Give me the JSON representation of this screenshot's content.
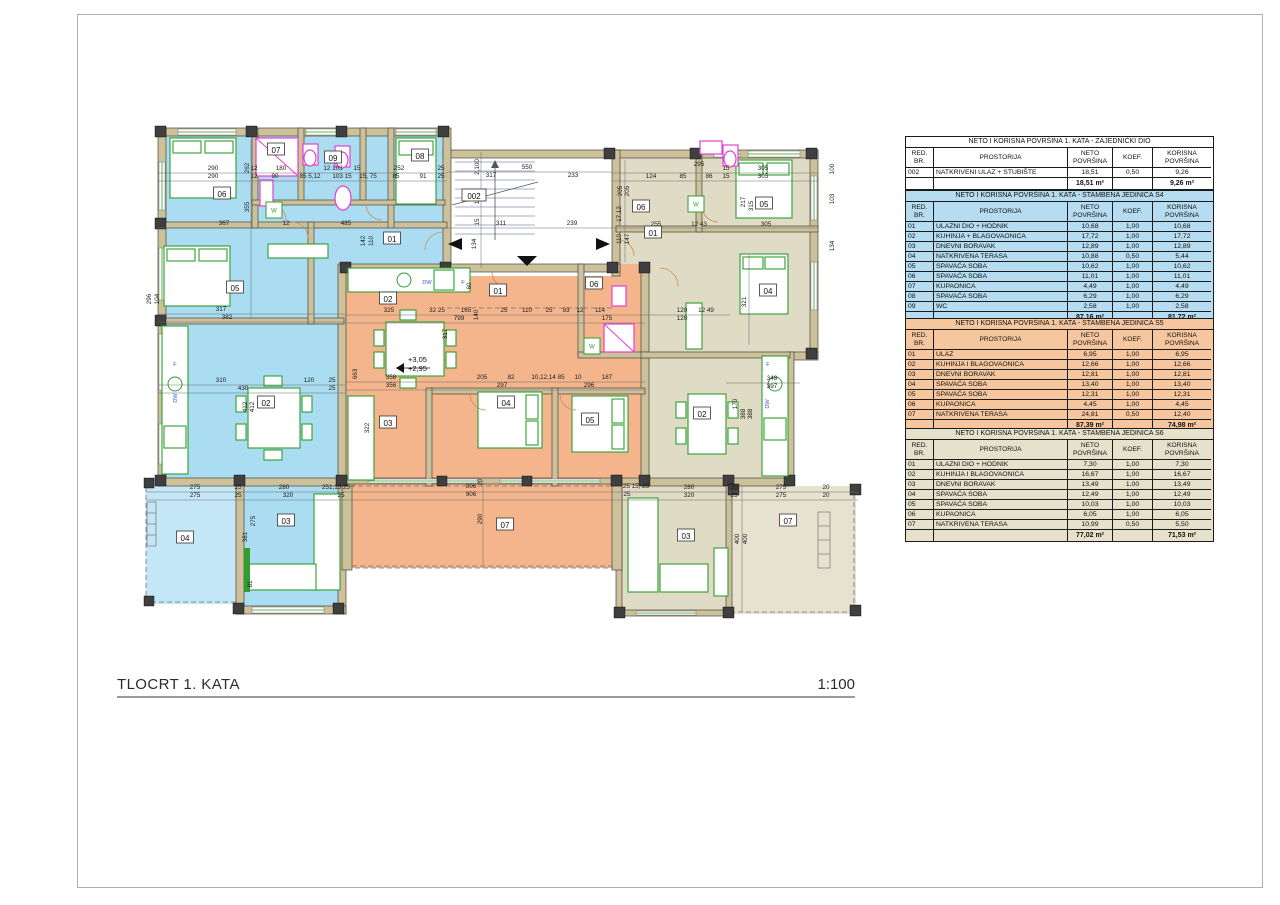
{
  "page": {
    "title": "TLOCRT 1. KATA",
    "scale": "1:100"
  },
  "colors": {
    "s4_blue": "#aadcf2",
    "s5_orange": "#f4b58d",
    "s6_beige": "#dfdbc4",
    "tbl_blue": "#b5dcf0",
    "tbl_orange": "#f6c79f",
    "tbl_beige": "#e5e1ca",
    "tbl_white": "#ffffff",
    "furniture_green": "#2f9e2f",
    "fixture_pink": "#e33fd2"
  },
  "plan": {
    "stairs_label": "002",
    "elevation": {
      "upper": "+3,05",
      "lower": "+2,95",
      "x": 408,
      "y": 362
    },
    "room_labels": [
      {
        "t": "06",
        "x": 222,
        "y": 196
      },
      {
        "t": "07",
        "x": 276,
        "y": 152
      },
      {
        "t": "09",
        "x": 333,
        "y": 160
      },
      {
        "t": "08",
        "x": 420,
        "y": 158
      },
      {
        "t": "05",
        "x": 235,
        "y": 290
      },
      {
        "t": "01",
        "x": 392,
        "y": 241
      },
      {
        "t": "02",
        "x": 266,
        "y": 405
      },
      {
        "t": "03",
        "x": 286,
        "y": 523
      },
      {
        "t": "04",
        "x": 185,
        "y": 540
      },
      {
        "t": "002",
        "x": 474,
        "y": 198
      },
      {
        "t": "02",
        "x": 388,
        "y": 301
      },
      {
        "t": "01",
        "x": 498,
        "y": 293
      },
      {
        "t": "06",
        "x": 594,
        "y": 286
      },
      {
        "t": "03",
        "x": 388,
        "y": 425
      },
      {
        "t": "04",
        "x": 506,
        "y": 405
      },
      {
        "t": "05",
        "x": 590,
        "y": 422
      },
      {
        "t": "07",
        "x": 505,
        "y": 527
      },
      {
        "t": "06",
        "x": 641,
        "y": 209
      },
      {
        "t": "01",
        "x": 653,
        "y": 235
      },
      {
        "t": "05",
        "x": 764,
        "y": 206
      },
      {
        "t": "04",
        "x": 768,
        "y": 293
      },
      {
        "t": "02",
        "x": 702,
        "y": 416
      },
      {
        "t": "03",
        "x": 686,
        "y": 538
      },
      {
        "t": "07",
        "x": 788,
        "y": 523
      }
    ],
    "appliance_labels": [
      {
        "t": "F",
        "x": 175,
        "y": 366
      },
      {
        "t": "DW",
        "x": 177,
        "y": 398,
        "v": 1
      },
      {
        "t": "DW",
        "x": 427,
        "y": 284
      },
      {
        "t": "F",
        "x": 463,
        "y": 284
      },
      {
        "t": "F",
        "x": 768,
        "y": 366
      },
      {
        "t": "DW",
        "x": 769,
        "y": 404,
        "v": 1
      },
      {
        "t": "W",
        "x": 274,
        "y": 210
      },
      {
        "t": "W",
        "x": 592,
        "y": 346
      },
      {
        "t": "W",
        "x": 696,
        "y": 204
      }
    ],
    "dims": [
      {
        "t": "290",
        "x": 213,
        "y": 170
      },
      {
        "t": "290",
        "x": 213,
        "y": 178
      },
      {
        "t": "12",
        "x": 254,
        "y": 170
      },
      {
        "t": "180",
        "x": 281,
        "y": 170
      },
      {
        "t": "12",
        "x": 254,
        "y": 178
      },
      {
        "t": "90",
        "x": 275,
        "y": 178
      },
      {
        "t": "85 5,12",
        "x": 310,
        "y": 178
      },
      {
        "t": "12 103",
        "x": 333,
        "y": 170
      },
      {
        "t": "103 15",
        "x": 342,
        "y": 178
      },
      {
        "t": "15",
        "x": 357,
        "y": 170
      },
      {
        "t": "15, 75",
        "x": 368,
        "y": 178
      },
      {
        "t": "252",
        "x": 399,
        "y": 170
      },
      {
        "t": "85",
        "x": 396,
        "y": 178
      },
      {
        "t": "91",
        "x": 423,
        "y": 178
      },
      {
        "t": "25",
        "x": 441,
        "y": 170
      },
      {
        "t": "25",
        "x": 441,
        "y": 178
      },
      {
        "t": "317",
        "x": 491,
        "y": 177
      },
      {
        "t": "550",
        "x": 527,
        "y": 169
      },
      {
        "t": "233",
        "x": 573,
        "y": 177
      },
      {
        "t": "295",
        "x": 699,
        "y": 166
      },
      {
        "t": "124",
        "x": 651,
        "y": 178
      },
      {
        "t": "85",
        "x": 683,
        "y": 178
      },
      {
        "t": "86",
        "x": 709,
        "y": 178
      },
      {
        "t": "15",
        "x": 726,
        "y": 170
      },
      {
        "t": "15",
        "x": 726,
        "y": 178
      },
      {
        "t": "305",
        "x": 763,
        "y": 170
      },
      {
        "t": "305",
        "x": 763,
        "y": 178
      },
      {
        "t": "367",
        "x": 224,
        "y": 225
      },
      {
        "t": "12",
        "x": 286,
        "y": 225
      },
      {
        "t": "485",
        "x": 346,
        "y": 225
      },
      {
        "t": "311",
        "x": 501,
        "y": 225
      },
      {
        "t": "239",
        "x": 572,
        "y": 225
      },
      {
        "t": "255",
        "x": 656,
        "y": 226
      },
      {
        "t": "12 43",
        "x": 699,
        "y": 226
      },
      {
        "t": "305",
        "x": 766,
        "y": 226
      },
      {
        "t": "317",
        "x": 221,
        "y": 311
      },
      {
        "t": "382",
        "x": 227,
        "y": 319
      },
      {
        "t": "310",
        "x": 221,
        "y": 382
      },
      {
        "t": "120",
        "x": 309,
        "y": 382
      },
      {
        "t": "430",
        "x": 243,
        "y": 390
      },
      {
        "t": "25",
        "x": 332,
        "y": 382
      },
      {
        "t": "25",
        "x": 332,
        "y": 390
      },
      {
        "t": "325",
        "x": 389,
        "y": 312
      },
      {
        "t": "32 25",
        "x": 437,
        "y": 312
      },
      {
        "t": "165",
        "x": 466,
        "y": 312
      },
      {
        "t": "799",
        "x": 459,
        "y": 320
      },
      {
        "t": "25",
        "x": 504,
        "y": 312
      },
      {
        "t": "110",
        "x": 527,
        "y": 312
      },
      {
        "t": "25",
        "x": 549,
        "y": 312
      },
      {
        "t": "93",
        "x": 566,
        "y": 312
      },
      {
        "t": "12",
        "x": 580,
        "y": 312
      },
      {
        "t": "114",
        "x": 600,
        "y": 312
      },
      {
        "t": "175",
        "x": 607,
        "y": 320
      },
      {
        "t": "120",
        "x": 682,
        "y": 312
      },
      {
        "t": "120",
        "x": 682,
        "y": 320
      },
      {
        "t": "12 49",
        "x": 706,
        "y": 312
      },
      {
        "t": "358",
        "x": 391,
        "y": 379
      },
      {
        "t": "356",
        "x": 391,
        "y": 387
      },
      {
        "t": "205",
        "x": 482,
        "y": 379
      },
      {
        "t": "82",
        "x": 511,
        "y": 379
      },
      {
        "t": "297",
        "x": 502,
        "y": 387
      },
      {
        "t": "10,12,14 85",
        "x": 548,
        "y": 379
      },
      {
        "t": "10",
        "x": 578,
        "y": 379
      },
      {
        "t": "187",
        "x": 607,
        "y": 379
      },
      {
        "t": "296",
        "x": 589,
        "y": 387
      },
      {
        "t": "348",
        "x": 772,
        "y": 380
      },
      {
        "t": "397",
        "x": 772,
        "y": 388
      },
      {
        "t": "275",
        "x": 195,
        "y": 489
      },
      {
        "t": "275",
        "x": 195,
        "y": 497
      },
      {
        "t": "25",
        "x": 238,
        "y": 489
      },
      {
        "t": "25",
        "x": 238,
        "y": 497
      },
      {
        "t": "280",
        "x": 284,
        "y": 489
      },
      {
        "t": "320",
        "x": 288,
        "y": 497
      },
      {
        "t": "251,15,25",
        "x": 336,
        "y": 489
      },
      {
        "t": "25",
        "x": 341,
        "y": 497
      },
      {
        "t": "906",
        "x": 471,
        "y": 488
      },
      {
        "t": "906",
        "x": 471,
        "y": 496
      },
      {
        "t": "25 15, 25",
        "x": 636,
        "y": 488
      },
      {
        "t": "25",
        "x": 627,
        "y": 496
      },
      {
        "t": "280",
        "x": 689,
        "y": 489
      },
      {
        "t": "320",
        "x": 689,
        "y": 497
      },
      {
        "t": "25",
        "x": 734,
        "y": 489
      },
      {
        "t": "25",
        "x": 734,
        "y": 497
      },
      {
        "t": "275",
        "x": 781,
        "y": 489
      },
      {
        "t": "275",
        "x": 781,
        "y": 497
      },
      {
        "t": "20",
        "x": 826,
        "y": 489
      },
      {
        "t": "20",
        "x": 826,
        "y": 497
      },
      {
        "t": "262",
        "x": 249,
        "y": 168,
        "v": 1
      },
      {
        "t": "355",
        "x": 249,
        "y": 207,
        "v": 1
      },
      {
        "t": "296",
        "x": 151,
        "y": 299,
        "v": 1
      },
      {
        "t": "104",
        "x": 159,
        "y": 299,
        "v": 1
      },
      {
        "t": "2,100",
        "x": 479,
        "y": 167,
        "v": 1
      },
      {
        "t": "103",
        "x": 479,
        "y": 199,
        "v": 1
      },
      {
        "t": "15",
        "x": 479,
        "y": 222,
        "v": 1
      },
      {
        "t": "134",
        "x": 476,
        "y": 244,
        "v": 1
      },
      {
        "t": "100",
        "x": 834,
        "y": 169,
        "v": 1
      },
      {
        "t": "103",
        "x": 834,
        "y": 199,
        "v": 1
      },
      {
        "t": "134",
        "x": 834,
        "y": 246,
        "v": 1
      },
      {
        "t": "205",
        "x": 622,
        "y": 191,
        "v": 1
      },
      {
        "t": "205",
        "x": 629,
        "y": 191,
        "v": 1
      },
      {
        "t": "17,12",
        "x": 621,
        "y": 214,
        "v": 1
      },
      {
        "t": "110",
        "x": 621,
        "y": 239,
        "v": 1
      },
      {
        "t": "147",
        "x": 629,
        "y": 239,
        "v": 1
      },
      {
        "t": "142",
        "x": 365,
        "y": 241,
        "v": 1
      },
      {
        "t": "110",
        "x": 373,
        "y": 241,
        "v": 1
      },
      {
        "t": "217",
        "x": 745,
        "y": 202,
        "v": 1
      },
      {
        "t": "315",
        "x": 753,
        "y": 206,
        "v": 1
      },
      {
        "t": "412",
        "x": 247,
        "y": 407,
        "v": 1
      },
      {
        "t": "412",
        "x": 254,
        "y": 407,
        "v": 1
      },
      {
        "t": "663",
        "x": 357,
        "y": 374,
        "v": 1
      },
      {
        "t": "322",
        "x": 369,
        "y": 428,
        "v": 1
      },
      {
        "t": "317",
        "x": 447,
        "y": 334,
        "v": 1
      },
      {
        "t": "140",
        "x": 478,
        "y": 315,
        "v": 1
      },
      {
        "t": "60",
        "x": 471,
        "y": 286,
        "v": 1
      },
      {
        "t": "20",
        "x": 482,
        "y": 482,
        "v": 1
      },
      {
        "t": "290",
        "x": 482,
        "y": 519,
        "v": 1
      },
      {
        "t": "400",
        "x": 739,
        "y": 539,
        "v": 1
      },
      {
        "t": "400",
        "x": 747,
        "y": 539,
        "v": 1
      },
      {
        "t": "170",
        "x": 737,
        "y": 404,
        "v": 1
      },
      {
        "t": "321",
        "x": 746,
        "y": 302,
        "v": 1
      },
      {
        "t": "388",
        "x": 745,
        "y": 414,
        "v": 1
      },
      {
        "t": "388",
        "x": 752,
        "y": 414,
        "v": 1
      },
      {
        "t": "381",
        "x": 247,
        "y": 537,
        "v": 1
      },
      {
        "t": "275",
        "x": 255,
        "y": 521,
        "v": 1
      },
      {
        "t": "81",
        "x": 252,
        "y": 584,
        "v": 1
      }
    ]
  },
  "tables": [
    {
      "id": "zajednicki",
      "title": "NETO I KORISNA POVRŠINA 1. KATA - ZAJEDNIČKI DIO",
      "headers": [
        [
          "RED.",
          "BR."
        ],
        [
          "PROSTORIJA"
        ],
        [
          "NETO",
          "POVRŠINA"
        ],
        [
          "KOEF."
        ],
        [
          "KORISNA",
          "POVRŠINA"
        ]
      ],
      "rows": [
        [
          "002",
          "NATKRIVENI ULAZ + STUBIŠTE",
          "18,51",
          "0,50",
          "9,26"
        ]
      ],
      "total_neto": "18,51 m²",
      "total_korisna": "9,26 m²",
      "bg": "#ffffff"
    },
    {
      "id": "s4",
      "title": "NETO I KORISNA POVRŠINA 1. KATA - STAMBENA JEDINICA S4",
      "headers": [
        [
          "RED.",
          "BR."
        ],
        [
          "PROSTORIJA"
        ],
        [
          "NETO",
          "POVRŠINA"
        ],
        [
          "KOEF."
        ],
        [
          "KORISNA",
          "POVRŠINA"
        ]
      ],
      "rows": [
        [
          "01",
          "ULAZNI DIO + HODNIK",
          "10,68",
          "1,00",
          "10,68"
        ],
        [
          "02",
          "KUHINJA + BLAGOVAONICA",
          "17,72",
          "1,00",
          "17,72"
        ],
        [
          "03",
          "DNEVNI BORAVAK",
          "12,89",
          "1,00",
          "12,89"
        ],
        [
          "04",
          "NATKRIVENA TERASA",
          "10,88",
          "0,50",
          "5,44"
        ],
        [
          "05",
          "SPAVAĆA SOBA",
          "10,62",
          "1,00",
          "10,62"
        ],
        [
          "06",
          "SPAVAĆA SOBA",
          "11,01",
          "1,00",
          "11,01"
        ],
        [
          "07",
          "KUPAONICA",
          "4,49",
          "1,00",
          "4,49"
        ],
        [
          "08",
          "SPAVAĆA SOBA",
          "6,29",
          "1,00",
          "6,29"
        ],
        [
          "09",
          "WC",
          "2,58",
          "1,00",
          "2,58"
        ]
      ],
      "total_neto": "87,16 m²",
      "total_korisna": "81,72 m²",
      "bg": "#b5dcf0"
    },
    {
      "id": "s5",
      "title": "NETO I KORISNA POVRŠINA 1. KATA - STAMBENA JEDINICA S5",
      "headers": [
        [
          "RED.",
          "BR."
        ],
        [
          "PROSTORIJA"
        ],
        [
          "NETO",
          "POVRŠINA"
        ],
        [
          "KOEF."
        ],
        [
          "KORISNA",
          "POVRŠINA"
        ]
      ],
      "rows": [
        [
          "01",
          "ULAZ",
          "6,95",
          "1,00",
          "6,95"
        ],
        [
          "02",
          "KUHINJA I BLAGOVAONICA",
          "12,66",
          "1,00",
          "12,66"
        ],
        [
          "03",
          "DNEVNI BORAVAK",
          "12,81",
          "1,00",
          "12,81"
        ],
        [
          "04",
          "SPAVAĆA SOBA",
          "13,40",
          "1,00",
          "13,40"
        ],
        [
          "05",
          "SPAVAĆA SOBA",
          "12,31",
          "1,00",
          "12,31"
        ],
        [
          "06",
          "KUPAONICA",
          "4,45",
          "1,00",
          "4,45"
        ],
        [
          "07",
          "NATKRIVENA TERASA",
          "24,81",
          "0,50",
          "12,40"
        ]
      ],
      "total_neto": "87,39 m²",
      "total_korisna": "74,98 m²",
      "bg": "#f6c79f"
    },
    {
      "id": "s6",
      "title": "NETO I KORISNA POVRŠINA 1. KATA - STAMBENA JEDINICA S6",
      "headers": [
        [
          "RED.",
          "BR."
        ],
        [
          "PROSTORIJA"
        ],
        [
          "NETO",
          "POVRŠINA"
        ],
        [
          "KOEF."
        ],
        [
          "KORISNA",
          "POVRŠINA"
        ]
      ],
      "rows": [
        [
          "01",
          "ULAZNI DIO + HODNIK",
          "7,30",
          "1,00",
          "7,30"
        ],
        [
          "02",
          "KUHINJA I BLAGOVAONICA",
          "16,67",
          "1,00",
          "16,67"
        ],
        [
          "03",
          "DNEVNI BORAVAK",
          "13,49",
          "1,00",
          "13,49"
        ],
        [
          "04",
          "SPAVAĆA SOBA",
          "12,49",
          "1,00",
          "12,49"
        ],
        [
          "05",
          "SPAVAĆA SOBA",
          "10,03",
          "1,00",
          "10,03"
        ],
        [
          "06",
          "KUPAONICA",
          "6,05",
          "1,00",
          "6,05"
        ],
        [
          "07",
          "NATKRIVENA TERASA",
          "10,99",
          "0,50",
          "5,50"
        ]
      ],
      "total_neto": "77,02 m²",
      "total_korisna": "71,53 m²",
      "bg": "#e5e1ca"
    }
  ]
}
